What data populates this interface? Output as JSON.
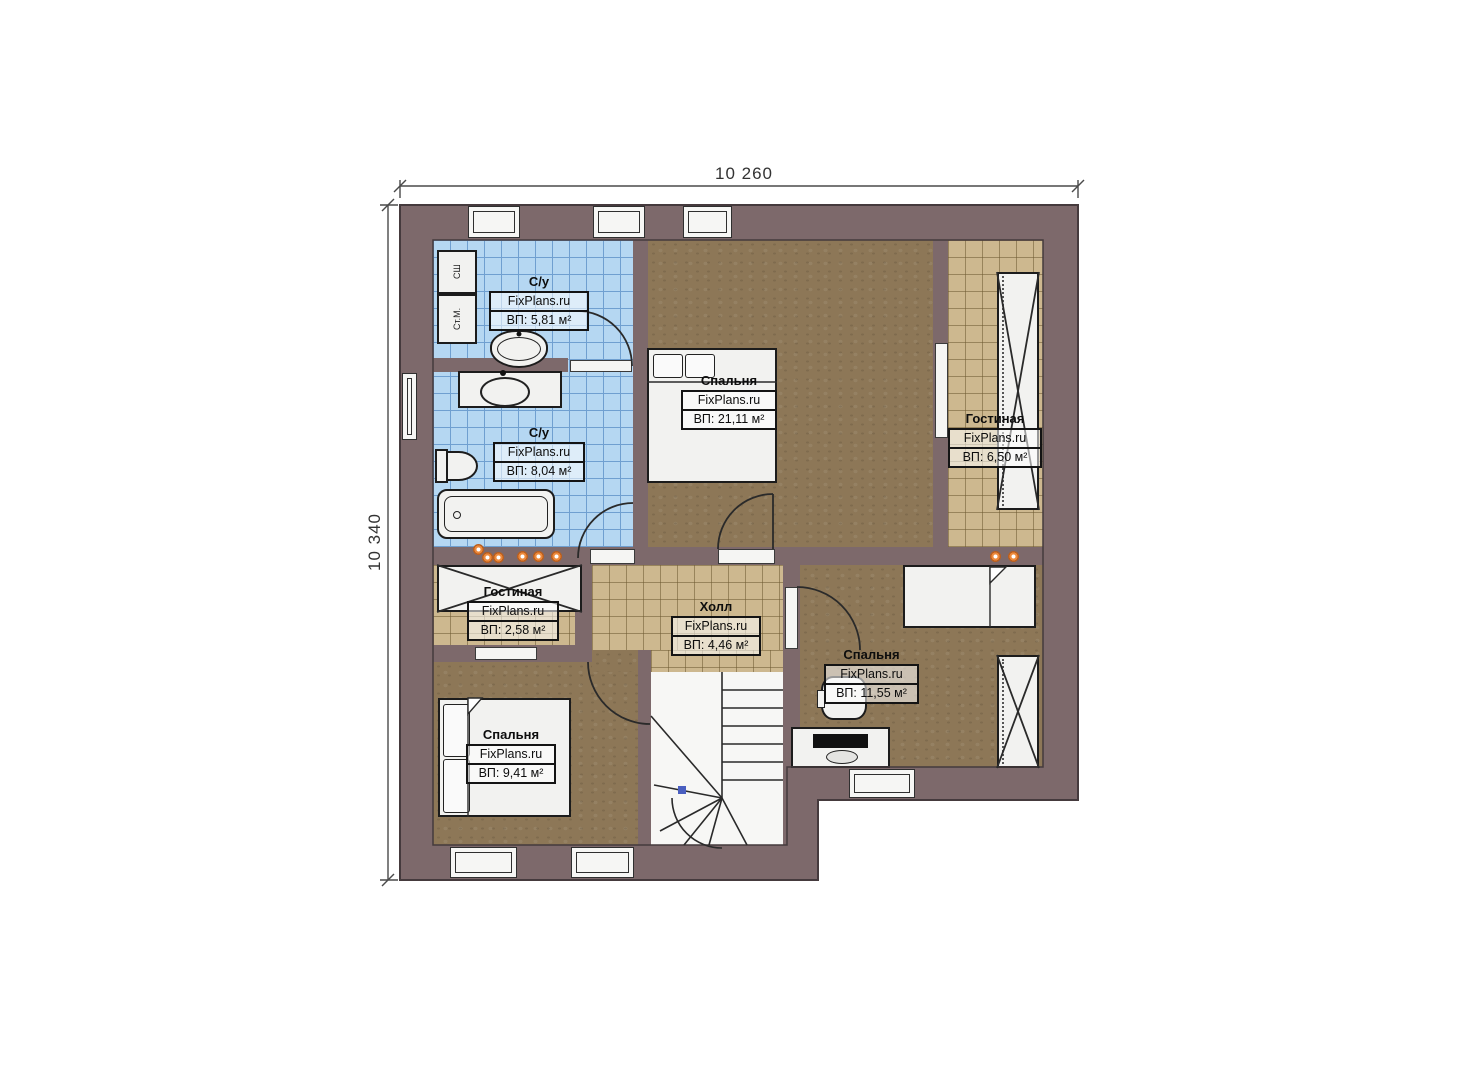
{
  "dimensions": {
    "width": "10 260",
    "height": "10 340"
  },
  "watermark": "FixPlans.ru",
  "rooms": {
    "bath_top": {
      "name": "С/у",
      "area": "ВП: 5,81 м²"
    },
    "bath_main": {
      "name": "С/у",
      "area": "ВП: 8,04 м²"
    },
    "bedroom_master": {
      "name": "Спальня",
      "area": "ВП: 21,11 м²"
    },
    "living_right": {
      "name": "Гостиная",
      "area": "ВП: 6,50 м²"
    },
    "living_left": {
      "name": "Гостиная",
      "area": "ВП: 2,58 м²"
    },
    "hall": {
      "name": "Холл",
      "area": "ВП: 4,46 м²"
    },
    "bedroom_right": {
      "name": "Спальня",
      "area": "ВП: 11,55 м²"
    },
    "bedroom_left": {
      "name": "Спальня",
      "area": "ВП: 9,41 м²"
    }
  },
  "appliances": {
    "dryer": "СШ",
    "washer": "Ст.М."
  },
  "colors": {
    "wall": "#7d696b",
    "tile_blue": "#b5d7f2",
    "tile_grid_blue": "#6f9fd0",
    "tile_tan": "#cdb88f",
    "floor_brown": "#8d7757",
    "light_dot": "#ed8a3c"
  }
}
